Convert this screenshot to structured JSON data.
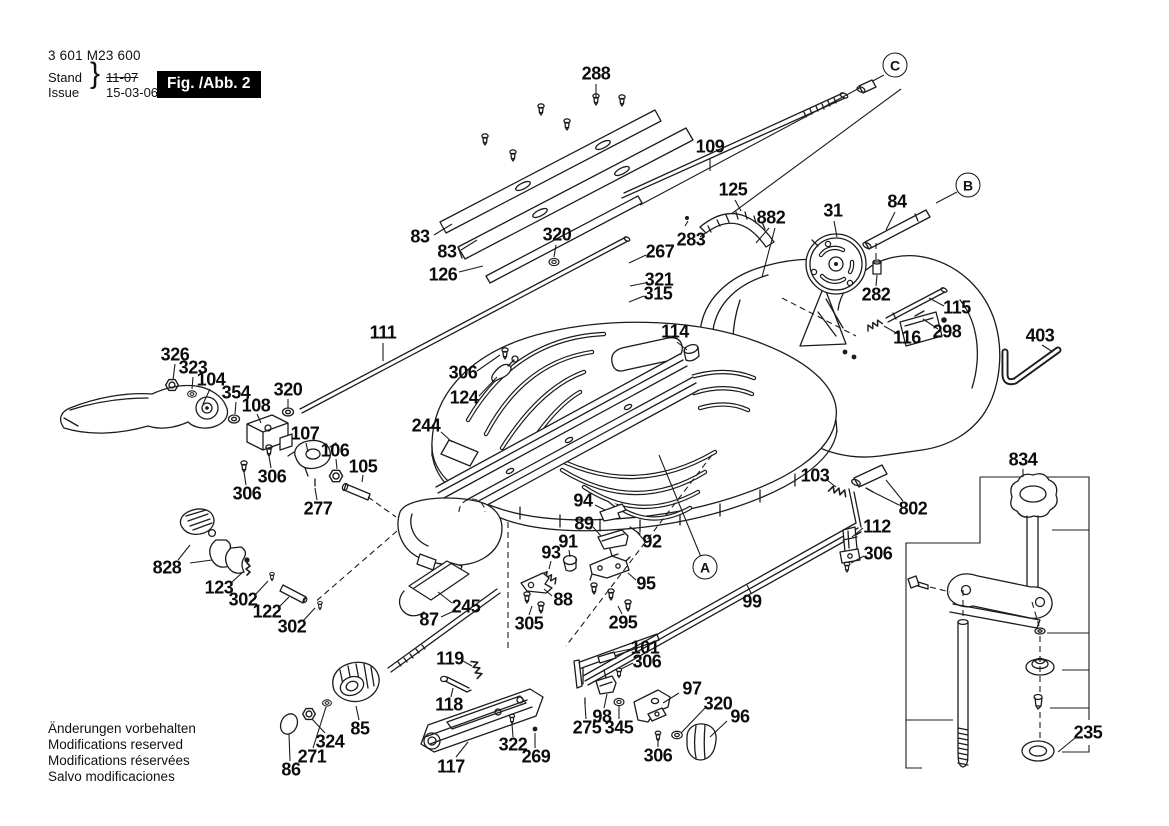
{
  "header": {
    "part_number": "3 601 M23 600",
    "stand_label": "Stand",
    "issue_label": "Issue",
    "brace": "}",
    "stand_value": "11-07",
    "issue_value": "15-03-06",
    "figure_caption": "Fig. /Abb. 2"
  },
  "footer": {
    "lines": [
      "Änderungen vorbehalten",
      "Modifications reserved",
      "Modifications réservées",
      "Salvo modificaciones"
    ]
  },
  "diagram": {
    "line_color": "#1c1c1c",
    "background": "#ffffff",
    "view_markers": [
      {
        "t": "C",
        "x": 895,
        "y": 65
      },
      {
        "t": "B",
        "x": 968,
        "y": 185
      },
      {
        "t": "A",
        "x": 705,
        "y": 567
      }
    ],
    "callouts": [
      {
        "t": "288",
        "x": 596,
        "y": 74
      },
      {
        "t": "109",
        "x": 710,
        "y": 147
      },
      {
        "t": "125",
        "x": 733,
        "y": 190
      },
      {
        "t": "882",
        "x": 771,
        "y": 218
      },
      {
        "t": "31",
        "x": 833,
        "y": 211
      },
      {
        "t": "84",
        "x": 897,
        "y": 202
      },
      {
        "t": "283",
        "x": 691,
        "y": 240
      },
      {
        "t": "267",
        "x": 660,
        "y": 252
      },
      {
        "t": "321",
        "x": 659,
        "y": 280
      },
      {
        "t": "315",
        "x": 658,
        "y": 294
      },
      {
        "t": "320",
        "x": 557,
        "y": 235
      },
      {
        "t": "83",
        "x": 420,
        "y": 237
      },
      {
        "t": "83",
        "x": 447,
        "y": 252
      },
      {
        "t": "126",
        "x": 443,
        "y": 275
      },
      {
        "t": "111",
        "x": 383,
        "y": 333
      },
      {
        "t": "114",
        "x": 675,
        "y": 332
      },
      {
        "t": "282",
        "x": 876,
        "y": 295
      },
      {
        "t": "115",
        "x": 957,
        "y": 308
      },
      {
        "t": "298",
        "x": 947,
        "y": 332
      },
      {
        "t": "116",
        "x": 907,
        "y": 338
      },
      {
        "t": "403",
        "x": 1040,
        "y": 336
      },
      {
        "t": "326",
        "x": 175,
        "y": 355
      },
      {
        "t": "323",
        "x": 193,
        "y": 368
      },
      {
        "t": "104",
        "x": 211,
        "y": 380
      },
      {
        "t": "354",
        "x": 236,
        "y": 393
      },
      {
        "t": "320",
        "x": 288,
        "y": 390
      },
      {
        "t": "108",
        "x": 256,
        "y": 406
      },
      {
        "t": "306",
        "x": 463,
        "y": 373
      },
      {
        "t": "124",
        "x": 464,
        "y": 398
      },
      {
        "t": "244",
        "x": 426,
        "y": 426
      },
      {
        "t": "107",
        "x": 305,
        "y": 434
      },
      {
        "t": "106",
        "x": 335,
        "y": 451
      },
      {
        "t": "105",
        "x": 363,
        "y": 467
      },
      {
        "t": "306",
        "x": 272,
        "y": 477
      },
      {
        "t": "306",
        "x": 247,
        "y": 494
      },
      {
        "t": "277",
        "x": 318,
        "y": 509
      },
      {
        "t": "828",
        "x": 167,
        "y": 568
      },
      {
        "t": "123",
        "x": 219,
        "y": 588
      },
      {
        "t": "302",
        "x": 243,
        "y": 600
      },
      {
        "t": "122",
        "x": 267,
        "y": 612
      },
      {
        "t": "302",
        "x": 292,
        "y": 627
      },
      {
        "t": "87",
        "x": 429,
        "y": 620
      },
      {
        "t": "245",
        "x": 466,
        "y": 607
      },
      {
        "t": "305",
        "x": 529,
        "y": 624
      },
      {
        "t": "88",
        "x": 563,
        "y": 600
      },
      {
        "t": "93",
        "x": 551,
        "y": 553
      },
      {
        "t": "91",
        "x": 568,
        "y": 542
      },
      {
        "t": "89",
        "x": 584,
        "y": 524
      },
      {
        "t": "94",
        "x": 583,
        "y": 501
      },
      {
        "t": "92",
        "x": 652,
        "y": 542
      },
      {
        "t": "95",
        "x": 646,
        "y": 584
      },
      {
        "t": "295",
        "x": 623,
        "y": 623
      },
      {
        "t": "119",
        "x": 450,
        "y": 659
      },
      {
        "t": "118",
        "x": 449,
        "y": 705
      },
      {
        "t": "117",
        "x": 451,
        "y": 767
      },
      {
        "t": "85",
        "x": 360,
        "y": 729
      },
      {
        "t": "324",
        "x": 330,
        "y": 742
      },
      {
        "t": "271",
        "x": 312,
        "y": 757
      },
      {
        "t": "86",
        "x": 291,
        "y": 770
      },
      {
        "t": "322",
        "x": 513,
        "y": 745
      },
      {
        "t": "269",
        "x": 536,
        "y": 757
      },
      {
        "t": "101",
        "x": 645,
        "y": 648
      },
      {
        "t": "306",
        "x": 647,
        "y": 662
      },
      {
        "t": "98",
        "x": 602,
        "y": 717
      },
      {
        "t": "275",
        "x": 587,
        "y": 728
      },
      {
        "t": "345",
        "x": 619,
        "y": 728
      },
      {
        "t": "97",
        "x": 692,
        "y": 689
      },
      {
        "t": "320",
        "x": 718,
        "y": 704
      },
      {
        "t": "96",
        "x": 740,
        "y": 717
      },
      {
        "t": "306",
        "x": 658,
        "y": 756
      },
      {
        "t": "103",
        "x": 815,
        "y": 476
      },
      {
        "t": "802",
        "x": 913,
        "y": 509
      },
      {
        "t": "112",
        "x": 877,
        "y": 527
      },
      {
        "t": "306",
        "x": 878,
        "y": 554
      },
      {
        "t": "99",
        "x": 752,
        "y": 602
      },
      {
        "t": "834",
        "x": 1023,
        "y": 460
      },
      {
        "t": "235",
        "x": 1088,
        "y": 733
      }
    ]
  }
}
